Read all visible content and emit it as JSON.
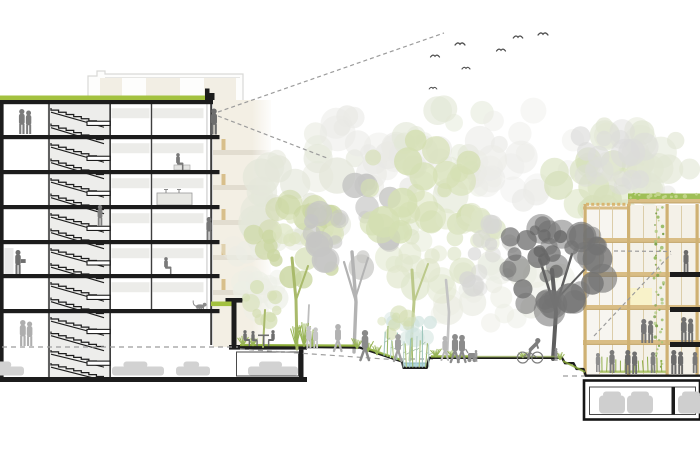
{
  "scene": {
    "width": 700,
    "height": 466,
    "description": "Architectural cross-section: 7-storey apartment block with stair core and underground parking at left, landscaped courtyard with trees and rain garden in the middle, 5-storey timber-frame building with green roof and underground parking at right, birds and dashed sight lines above"
  },
  "colors": {
    "line": "#1c1c1c",
    "wall": "#3e3e3e",
    "core": "#ededeb",
    "strip": "#ecece9",
    "green_roof": "#a3c13f",
    "grass": "#8fb03a",
    "grass_light": "#a5bd60",
    "water": "#aed6df",
    "water_line": "#8fb9c6",
    "timber": "#d9bd85",
    "timber_dark": "#b99b5e",
    "timber_col": "#cfb173",
    "mullion": "#d8c9a2",
    "dot": "#d9b571",
    "facade_bg": "#f2eee3",
    "facade_band": "#e2ddd0",
    "facade_post": "#d8bf8b",
    "wingA_bg": "#f7f5f0",
    "wingB_bg": "#f4f1e8",
    "pale_yellow": "#f8f2c9",
    "planting": "#8fae4a",
    "car": "#d2d2d2",
    "car_front": "#cfcfcf",
    "dash": "#9c9c9c",
    "bird": "#4f4f4f",
    "vine1": "#8fb558",
    "vine2": "#a9c77a",
    "vine3": "#7ba04b",
    "roofdot1": "#9bbf56",
    "roofdot2": "#c2d58a"
  },
  "left_building": {
    "slabs": [
      135,
      170,
      205,
      240,
      274,
      309
    ],
    "stories": [
      [
        104,
        35
      ],
      [
        139,
        35
      ],
      [
        174,
        35
      ],
      [
        209,
        35
      ],
      [
        244,
        34
      ],
      [
        278,
        35
      ],
      [
        313,
        33
      ],
      [
        346,
        30
      ]
    ],
    "understrip_tops": [
      104,
      139,
      174,
      209,
      244,
      278
    ]
  },
  "bg_facade_bands": [
    150,
    185,
    220,
    255,
    290
  ],
  "right_building": {
    "bands": [
      238,
      272,
      305,
      340
    ],
    "balcony_slabs": [
      272,
      307,
      342
    ],
    "columns": [
      583.5,
      627,
      665.5,
      695.5
    ],
    "mullions": [
      599,
      612,
      643,
      656,
      681
    ],
    "parapet_dots": {
      "x0": 586,
      "step": 5.2,
      "n": 9,
      "y": 202.8
    },
    "vine_x": 659
  },
  "canopies_back": [
    {
      "x": 320,
      "y": 195,
      "rx": 80,
      "ry": 62,
      "n": 26,
      "rmin": 8,
      "rmax": 20,
      "color": "#e4e7da",
      "op": 0.8,
      "seed": 11
    },
    {
      "x": 392,
      "y": 142,
      "rx": 62,
      "ry": 50,
      "n": 22,
      "rmin": 8,
      "rmax": 18,
      "color": "#e9e9e5",
      "op": 0.75,
      "seed": 12
    },
    {
      "x": 455,
      "y": 152,
      "rx": 56,
      "ry": 46,
      "n": 20,
      "rmin": 8,
      "rmax": 18,
      "color": "#e2e7d6",
      "op": 0.7,
      "seed": 13
    },
    {
      "x": 525,
      "y": 158,
      "rx": 56,
      "ry": 48,
      "n": 20,
      "rmin": 8,
      "rmax": 17,
      "color": "#ebebe7",
      "op": 0.7,
      "seed": 14
    },
    {
      "x": 252,
      "y": 272,
      "rx": 30,
      "ry": 46,
      "n": 16,
      "rmin": 6,
      "rmax": 13,
      "color": "#eceee5",
      "op": 0.7,
      "seed": 15
    },
    {
      "x": 598,
      "y": 182,
      "rx": 56,
      "ry": 40,
      "n": 20,
      "rmin": 8,
      "rmax": 16,
      "color": "#d6e0ba",
      "op": 0.8,
      "seed": 16
    },
    {
      "x": 648,
      "y": 148,
      "rx": 56,
      "ry": 46,
      "n": 20,
      "rmin": 8,
      "rmax": 17,
      "color": "#e1e6d3",
      "op": 0.75,
      "seed": 17
    },
    {
      "x": 612,
      "y": 158,
      "rx": 42,
      "ry": 38,
      "n": 16,
      "rmin": 7,
      "rmax": 15,
      "color": "#dcdcda",
      "op": 0.7,
      "seed": 18
    },
    {
      "x": 690,
      "y": 235,
      "rx": 40,
      "ry": 58,
      "n": 18,
      "rmin": 7,
      "rmax": 15,
      "color": "#e6e6e2",
      "op": 0.65,
      "seed": 19
    },
    {
      "x": 500,
      "y": 295,
      "rx": 70,
      "ry": 38,
      "n": 20,
      "rmin": 8,
      "rmax": 16,
      "color": "#eaece2",
      "op": 0.7,
      "seed": 20
    },
    {
      "x": 432,
      "y": 252,
      "rx": 46,
      "ry": 40,
      "n": 18,
      "rmin": 7,
      "rmax": 15,
      "color": "#dfe6cb",
      "op": 0.75,
      "seed": 21
    }
  ],
  "canopies_mid": [
    {
      "x": 297,
      "y": 243,
      "rx": 46,
      "ry": 42,
      "n": 22,
      "rmin": 6,
      "rmax": 14,
      "color": "#cbd7a2",
      "op": 0.85,
      "seed": 31
    },
    {
      "x": 310,
      "y": 225,
      "rx": 30,
      "ry": 26,
      "n": 12,
      "rmin": 5,
      "rmax": 11,
      "color": "#dce4bf",
      "op": 0.8,
      "seed": 32
    },
    {
      "x": 355,
      "y": 226,
      "rx": 48,
      "ry": 46,
      "n": 22,
      "rmin": 6,
      "rmax": 14,
      "color": "#c6c6c4",
      "op": 0.85,
      "seed": 33
    },
    {
      "x": 420,
      "y": 188,
      "rx": 66,
      "ry": 54,
      "n": 26,
      "rmin": 7,
      "rmax": 16,
      "color": "#d4dfb2",
      "op": 0.85,
      "seed": 34
    },
    {
      "x": 470,
      "y": 228,
      "rx": 36,
      "ry": 30,
      "n": 14,
      "rmin": 6,
      "rmax": 12,
      "color": "#dde5c6",
      "op": 0.8,
      "seed": 35
    },
    {
      "x": 480,
      "y": 255,
      "rx": 34,
      "ry": 36,
      "n": 14,
      "rmin": 6,
      "rmax": 12,
      "color": "#d6d6d4",
      "op": 0.75,
      "seed": 36
    },
    {
      "x": 266,
      "y": 300,
      "rx": 20,
      "ry": 24,
      "n": 10,
      "rmin": 4,
      "rmax": 9,
      "color": "#d5dfb4",
      "op": 0.8,
      "seed": 37
    }
  ],
  "canopies_front": [
    {
      "x": 557,
      "y": 264,
      "rx": 58,
      "ry": 48,
      "n": 30,
      "rmin": 7,
      "rmax": 16,
      "color": "#737373",
      "op": 0.88,
      "seed": 41
    },
    {
      "x": 545,
      "y": 252,
      "rx": 34,
      "ry": 30,
      "n": 12,
      "rmin": 5,
      "rmax": 11,
      "color": "#666666",
      "op": 0.85,
      "seed": 42
    }
  ],
  "canopies_water": [
    {
      "x": 408,
      "y": 330,
      "rx": 26,
      "ry": 16,
      "n": 10,
      "rmin": 5,
      "rmax": 10,
      "color": "#cfe2dd",
      "op": 0.7,
      "seed": 51
    },
    {
      "x": 394,
      "y": 324,
      "rx": 18,
      "ry": 13,
      "n": 8,
      "rmin": 4,
      "rmax": 9,
      "color": "#d3ddb0",
      "op": 0.7,
      "seed": 52
    }
  ],
  "trunks_mid": [
    {
      "pts": [
        [
          297,
          349
        ],
        [
          296,
          300
        ],
        [
          292,
          258
        ]
      ],
      "w": 3,
      "c": "#a9ba6b"
    },
    {
      "pts": [
        [
          296,
          300
        ],
        [
          308,
          266
        ]
      ],
      "w": 2,
      "c": "#a9ba6b"
    },
    {
      "pts": [
        [
          354,
          352
        ],
        [
          356,
          302
        ],
        [
          352,
          252
        ]
      ],
      "w": 3.4,
      "c": "#b3b3b3"
    },
    {
      "pts": [
        [
          356,
          302
        ],
        [
          344,
          262
        ]
      ],
      "w": 2.2,
      "c": "#b3b3b3"
    },
    {
      "pts": [
        [
          356,
          296
        ],
        [
          368,
          258
        ]
      ],
      "w": 2,
      "c": "#b3b3b3"
    },
    {
      "pts": [
        [
          410,
          360
        ],
        [
          414,
          302
        ],
        [
          412,
          270
        ]
      ],
      "w": 3,
      "c": "#bcc98b"
    },
    {
      "pts": [
        [
          414,
          302
        ],
        [
          428,
          264
        ]
      ],
      "w": 2,
      "c": "#bcc98b"
    },
    {
      "pts": [
        [
          447,
          358
        ],
        [
          449,
          312
        ],
        [
          446,
          280
        ]
      ],
      "w": 2.6,
      "c": "#c4c4c4"
    },
    {
      "pts": [
        [
          307,
          347
        ],
        [
          309,
          305
        ]
      ],
      "w": 1.8,
      "c": "#bdbdbd"
    },
    {
      "pts": [
        [
          263,
          347
        ],
        [
          265,
          310
        ]
      ],
      "w": 2,
      "c": "#a9ba6b"
    }
  ],
  "trunks_front": [
    {
      "pts": [
        [
          553,
          359
        ],
        [
          556,
          312
        ],
        [
          552,
          270
        ]
      ],
      "w": 4,
      "c": "#5e5e5e"
    },
    {
      "pts": [
        [
          556,
          312
        ],
        [
          540,
          260
        ]
      ],
      "w": 2.6,
      "c": "#5e5e5e"
    },
    {
      "pts": [
        [
          556,
          306
        ],
        [
          572,
          254
        ]
      ],
      "w": 2.4,
      "c": "#5e5e5e"
    },
    {
      "pts": [
        [
          556,
          300
        ],
        [
          584,
          270
        ]
      ],
      "w": 2,
      "c": "#5e5e5e"
    }
  ],
  "grass_strips": [
    [
      "M240,345 L358,345.6",
      2.2,
      "#8fb03a",
      0.95
    ],
    [
      "M363,347 L400,359.6",
      2.2,
      "#8fb03a",
      0.9
    ],
    [
      "M431,356.4 L470,356.4",
      2.4,
      "#8fb03a",
      0.9
    ],
    [
      "M470,356.6 L561,356.6",
      1.8,
      "#a5bd60",
      0.65
    ],
    [
      "M563,361 L585,372",
      2.0,
      "#8fb03a",
      0.8
    ]
  ],
  "grass_tufts": [
    [
      243,
      345.5,
      10,
      6
    ],
    [
      253,
      346,
      9,
      5
    ],
    [
      296,
      347,
      22,
      6
    ],
    [
      304,
      347,
      27,
      7
    ],
    [
      312,
      347,
      18,
      6
    ],
    [
      357,
      349,
      12,
      6
    ],
    [
      368,
      352,
      11,
      6
    ],
    [
      377,
      355,
      10,
      5
    ],
    [
      436,
      357,
      9,
      6
    ],
    [
      452,
      357,
      8,
      5
    ],
    [
      523,
      358,
      7,
      5
    ],
    [
      560,
      360,
      8,
      5
    ]
  ],
  "people": [
    {
      "t": "pair",
      "x": 25,
      "y": 134,
      "h": 25,
      "c": "#7c7c7c"
    },
    {
      "t": "stand",
      "x": 214,
      "y": 134.5,
      "h": 26,
      "c": "#6e6e6e"
    },
    {
      "t": "sit",
      "x": 178,
      "y": 170,
      "h": 17,
      "c": "#787878",
      "d": 1
    },
    {
      "t": "stand",
      "x": 100,
      "y": 226,
      "h": 21,
      "c": "#7d7d7d"
    },
    {
      "t": "stand",
      "x": 209,
      "y": 240,
      "h": 23,
      "c": "#757575"
    },
    {
      "t": "hold",
      "x": 18,
      "y": 274,
      "h": 24,
      "c": "#6f6f6f"
    },
    {
      "t": "sit",
      "x": 166,
      "y": 274,
      "h": 17,
      "c": "#7a7a7a",
      "d": 1
    },
    {
      "t": "pair",
      "x": 26,
      "y": 346,
      "h": 26,
      "c": "#aeaeae"
    },
    {
      "t": "cat",
      "x": 200,
      "y": 309,
      "h": 6,
      "c": "#8a8a8a"
    },
    {
      "t": "cafe",
      "x": 245,
      "y": 346,
      "h": 16,
      "c": "#6e6e6e"
    },
    {
      "t": "pair",
      "x": 312,
      "y": 349,
      "h": 23,
      "c": "#c6c6c6"
    },
    {
      "t": "walk",
      "x": 338,
      "y": 351,
      "h": 27,
      "c": "#b2b2b2"
    },
    {
      "t": "walk",
      "x": 365,
      "y": 360,
      "h": 30,
      "c": "#8a8a8a"
    },
    {
      "t": "walk",
      "x": 398,
      "y": 361,
      "h": 27,
      "c": "#a0a0a0"
    },
    {
      "t": "walk",
      "x": 445,
      "y": 360,
      "h": 24,
      "c": "#b8b8b8"
    },
    {
      "t": "stroller",
      "x": 455,
      "y": 362,
      "h": 28,
      "c": "#8b8b8b"
    },
    {
      "t": "child",
      "x": 476,
      "y": 362,
      "h": 12,
      "c": "#9a9a9a"
    },
    {
      "t": "cyclist",
      "x": 530,
      "y": 363,
      "h": 26,
      "c": "#7e7e7e"
    },
    {
      "t": "child",
      "x": 556,
      "y": 361,
      "h": 13,
      "c": "#8f8f8f"
    },
    {
      "t": "stand",
      "x": 686,
      "y": 272,
      "h": 22,
      "c": "#6b6b6b"
    },
    {
      "t": "pair",
      "x": 687,
      "y": 342,
      "h": 25,
      "c": "#707070"
    },
    {
      "t": "pair",
      "x": 647,
      "y": 343,
      "h": 24,
      "c": "#767676"
    },
    {
      "t": "stand",
      "x": 612,
      "y": 373,
      "h": 23,
      "c": "#7b7b7b"
    },
    {
      "t": "pair",
      "x": 631,
      "y": 374,
      "h": 24,
      "c": "#6f6f6f"
    },
    {
      "t": "stand",
      "x": 653,
      "y": 373,
      "h": 21,
      "c": "#808080"
    },
    {
      "t": "pair",
      "x": 677,
      "y": 374,
      "h": 24,
      "c": "#6c6c6c"
    },
    {
      "t": "stand",
      "x": 695,
      "y": 373,
      "h": 21,
      "c": "#787878"
    },
    {
      "t": "stand",
      "x": 598,
      "y": 372,
      "h": 19,
      "c": "#8e8e8e"
    }
  ],
  "cars_side": [
    [
      -16,
      375.5,
      40
    ],
    [
      112,
      375.5,
      52
    ],
    [
      176,
      375.5,
      34
    ],
    [
      248,
      375.5,
      50
    ]
  ],
  "cars_front": [
    [
      612,
      413.5
    ],
    [
      640,
      413.5
    ],
    [
      691,
      413.5
    ]
  ],
  "birds": [
    [
      435,
      57,
      1
    ],
    [
      460,
      45,
      1.1
    ],
    [
      466,
      69,
      0.9
    ],
    [
      501,
      51,
      1
    ],
    [
      518,
      38,
      1.05
    ],
    [
      543,
      35,
      1.1
    ],
    [
      433,
      89,
      0.85
    ]
  ],
  "sight_lines": [
    [
      218,
      112,
      444,
      33
    ],
    [
      218,
      116,
      327,
      158
    ],
    [
      614,
      251,
      671,
      251.5
    ],
    [
      594,
      336,
      671,
      254
    ]
  ]
}
